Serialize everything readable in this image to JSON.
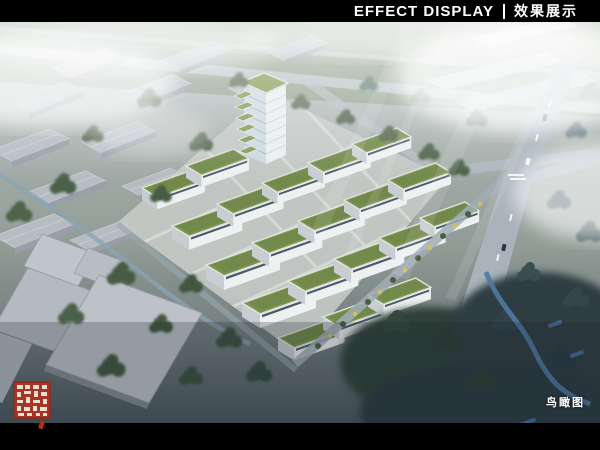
{
  "header": {
    "title_en": "EFFECT DISPLAY",
    "divider": "|",
    "title_zh": "效果展示",
    "bg_color": "#000000",
    "text_color": "#ffffff"
  },
  "render": {
    "caption": "鸟瞰图",
    "subject": "Bird's-eye aerial rendering of an industrial park campus: white multi-storey buildings with green roofs and a stepped green high-rise tower, surrounded by grey warehouses, tree belts, a main road intersection on the right and a river through dark woods at the lower right",
    "colors": {
      "green_roof": "#7c9352",
      "building_wall": "#edf0f2",
      "terrain": "#97a39b",
      "road": "#aab4bc",
      "trees": "#4c6149",
      "dark_trees": "#2f4038",
      "river": "#4f79a4",
      "mist": "#ffffff",
      "seal_red": "#a93524"
    }
  }
}
